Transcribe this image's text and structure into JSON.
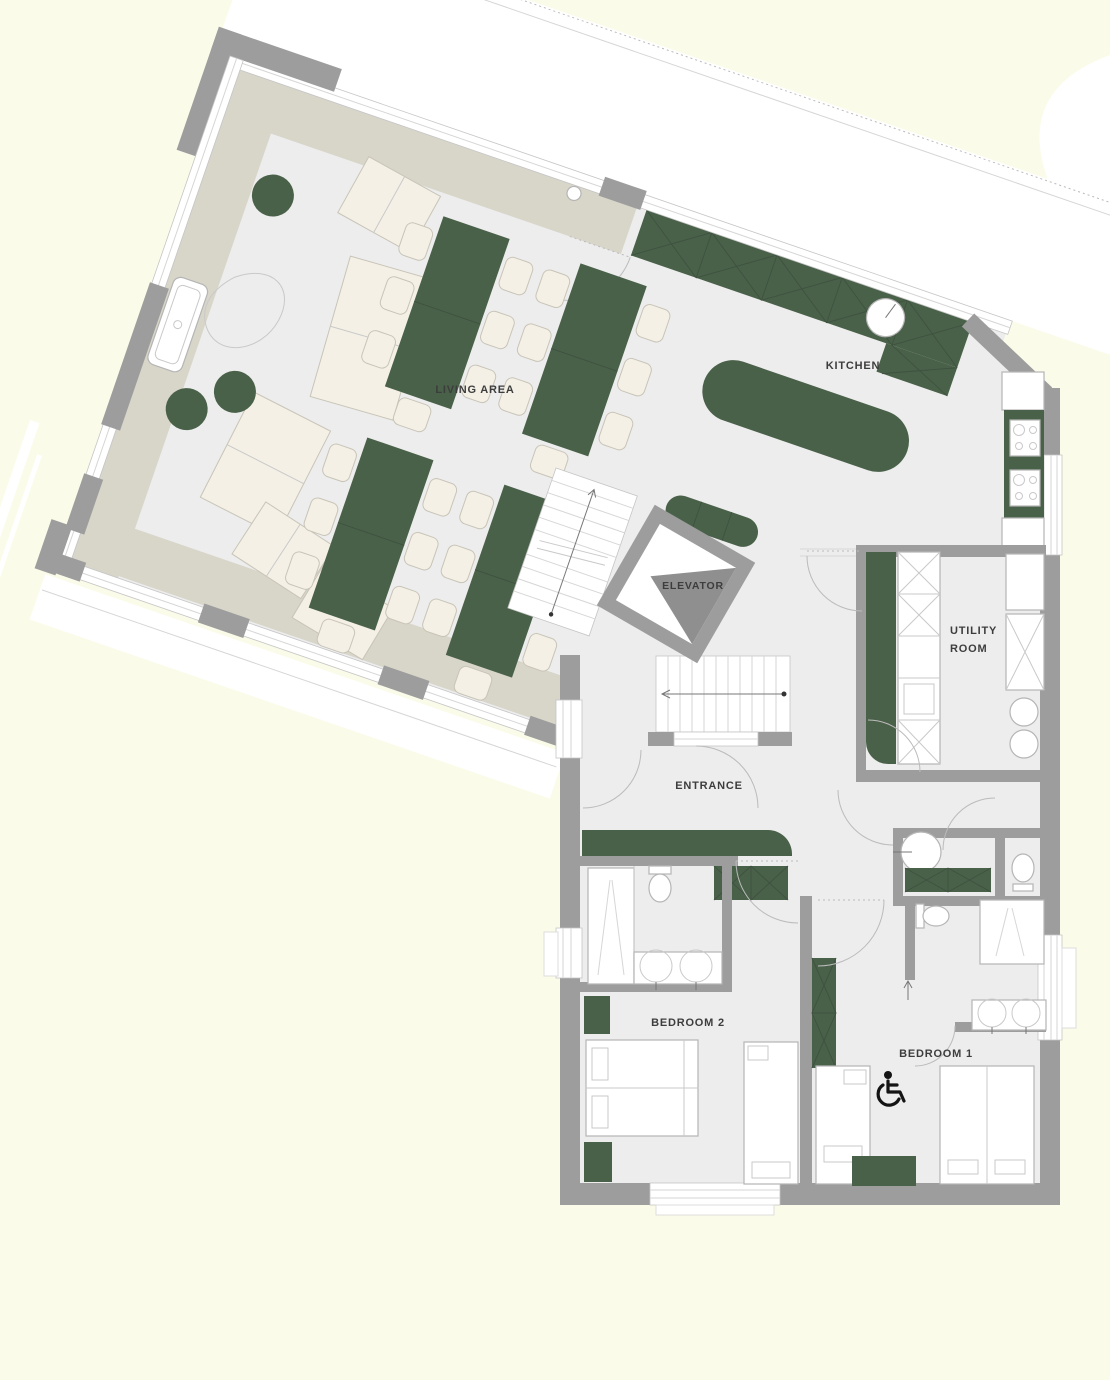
{
  "colors": {
    "background": "#fbfbe9",
    "floor": "#ededed",
    "band": "#d8d5c9",
    "wall": "#9d9d9d",
    "green": "#4a6149",
    "cream": "#f4f0e6",
    "line": "#c9c9c9",
    "text": "#3d3d3d",
    "icon": "#141414"
  },
  "rooms": {
    "living_area": {
      "label": "LIVING AREA"
    },
    "kitchen": {
      "label": "KITCHEN"
    },
    "elevator": {
      "label": "ELEVATOR"
    },
    "utility_room": {
      "label_line_1": "UTILITY",
      "label_line_2": "ROOM"
    },
    "entrance": {
      "label": "ENTRANCE"
    },
    "bedroom_2": {
      "label": "BEDROOM 2"
    },
    "bedroom_1": {
      "label": "BEDROOM 1"
    }
  }
}
